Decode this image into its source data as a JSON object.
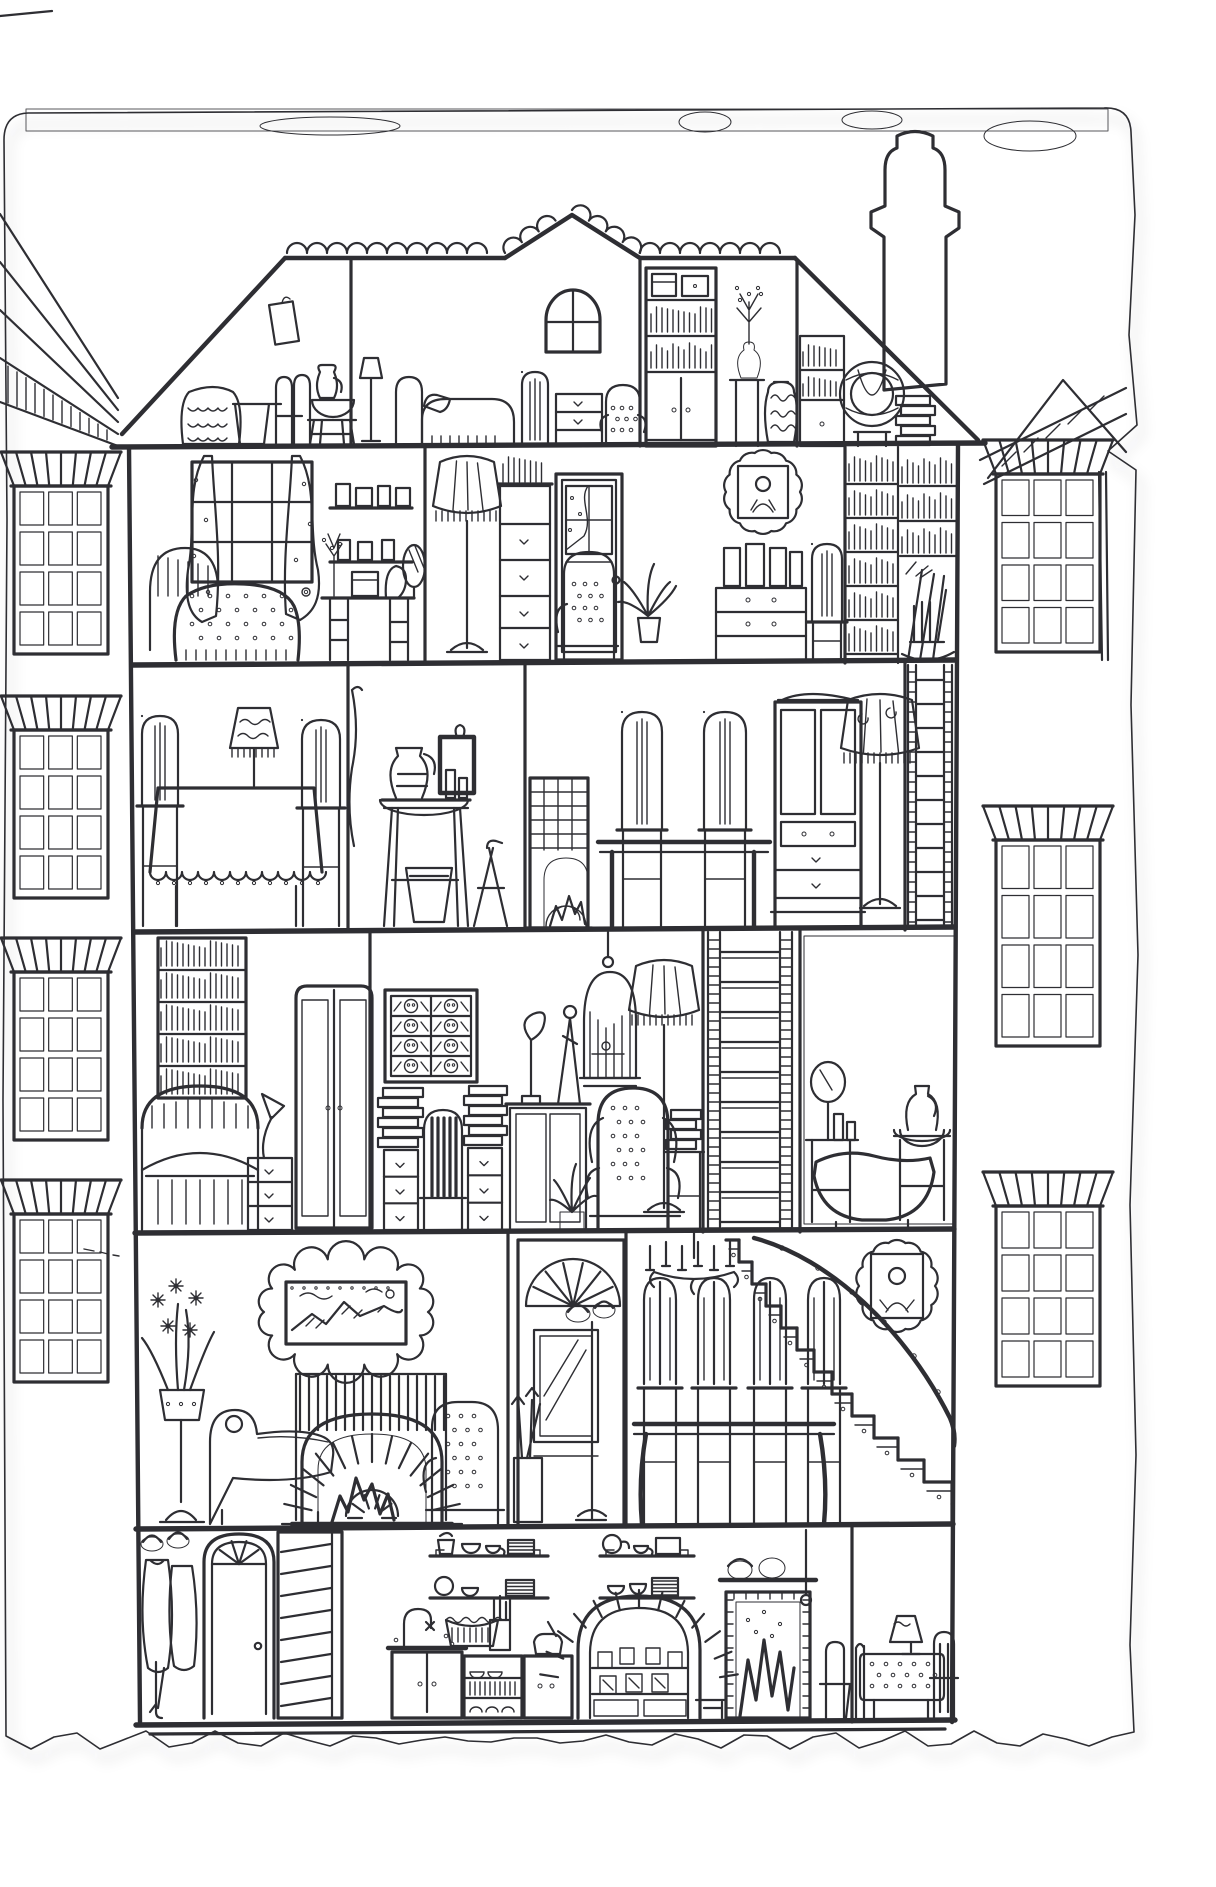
{
  "illustration": {
    "title": "Ink drawing: cross-section of a six-storey dollhouse on torn paper",
    "floors": [
      {
        "name": "attic",
        "rooms": [
          {
            "name": "luggage-room",
            "items": [
              "hanging-picture",
              "wicker-basket",
              "bucket",
              "folding-chair",
              "stool-with-bowl",
              "jug"
            ]
          },
          {
            "name": "attic-bedroom",
            "items": [
              "reading-lamp",
              "single-bed",
              "slat-chair",
              "arched-gable-window",
              "dresser",
              "tufted-chair"
            ]
          },
          {
            "name": "attic-store",
            "items": [
              "shelf-cabinet",
              "flower-vase-on-stand",
              "patterned-jar",
              "small-bookcase",
              "round-wicker-chair",
              "book-stack"
            ]
          }
        ]
      },
      {
        "name": "bedroom-floor",
        "rooms": [
          {
            "name": "bedroom",
            "items": [
              "curtained-window",
              "double-bed",
              "picture-shelves",
              "dressing-table-with-mirror"
            ]
          },
          {
            "name": "boudoir",
            "items": [
              "fringed-floor-lamp",
              "tall-dresser",
              "glazed-door",
              "dotted-armchair",
              "potted-plant",
              "framed-portrait",
              "writing-bureau",
              "side-chair"
            ]
          },
          {
            "name": "library-wall",
            "items": [
              "book-columns",
              "brooms",
              "rocking-chair"
            ]
          }
        ]
      },
      {
        "name": "dining-floor",
        "rooms": [
          {
            "name": "dining-room",
            "items": [
              "tablecloth-table",
              "table-lamp",
              "slat-chairs",
              "hanging-cloth"
            ]
          },
          {
            "name": "wash-room",
            "items": [
              "wall-picture",
              "washstand-jug-and-bowl",
              "bucket",
              "folding-chair"
            ]
          },
          {
            "name": "parlour",
            "items": [
              "mesh-stove",
              "long-table",
              "slat-chairs",
              "china-cabinet",
              "fringed-floor-lamp"
            ]
          },
          {
            "name": "ladder-shaft",
            "items": [
              "wall-ladder"
            ]
          }
        ]
      },
      {
        "name": "study-floor",
        "rooms": [
          {
            "name": "study",
            "items": [
              "tall-bookcase",
              "daybed",
              "desk-lamp",
              "drawer-chest",
              "wardrobe"
            ]
          },
          {
            "name": "studio",
            "items": [
              "faces-picture",
              "book-stacks",
              "striped-chair",
              "sculpture-cabinet",
              "spiky-plant",
              "wingback-chair",
              "birdcage",
              "fringed-lamp",
              "book-table"
            ]
          },
          {
            "name": "tall-ladder-shaft",
            "items": [
              "tall-ladder"
            ]
          },
          {
            "name": "bathroom",
            "items": [
              "tiled-wall",
              "vanity-mirror",
              "stool",
              "bathtub",
              "washstand"
            ]
          }
        ]
      },
      {
        "name": "living-floor",
        "rooms": [
          {
            "name": "drawing-room",
            "items": [
              "flower-stand",
              "chaise",
              "fire-screen",
              "brick-fireplace",
              "landscape-painting",
              "dotted-armchair",
              "umbrella-stand"
            ]
          },
          {
            "name": "hall",
            "items": [
              "fanlight",
              "hall-mirror",
              "coat-stand"
            ]
          },
          {
            "name": "stair-hall",
            "items": [
              "candle-chandelier",
              "hall-table",
              "hall-chairs",
              "curved-staircase",
              "oval-portrait"
            ]
          }
        ]
      },
      {
        "name": "kitchen-floor",
        "rooms": [
          {
            "name": "entry",
            "items": [
              "coat-rack",
              "front-door-with-fanlight",
              "basement-stairs"
            ]
          },
          {
            "name": "kitchen",
            "items": [
              "dish-shelves",
              "sink-cabinet",
              "mixing-bowl",
              "utensil-jar",
              "dish-rack",
              "larder-cabinet",
              "brick-oven",
              "black-hearth",
              "stool",
              "kitchen-chair"
            ]
          },
          {
            "name": "breakfast-nook",
            "items": [
              "dotted-cloth-table",
              "small-lamp",
              "nook-chairs"
            ]
          }
        ]
      }
    ],
    "exterior": {
      "items": [
        "scalloped-roof-ridge",
        "gable-window",
        "chimney"
      ],
      "background": [
        "left-neighbour-windows",
        "right-neighbour-windows",
        "torn-paper-edge"
      ]
    }
  },
  "palette": {
    "ink": "#2e2e33",
    "paper": "#f4f4f1",
    "paper_edge": "#d8d8d3",
    "background_ink": "#a7a7ad",
    "stain": "#e7e7e2",
    "shadow": "#aeaeae",
    "white": "#ffffff"
  }
}
